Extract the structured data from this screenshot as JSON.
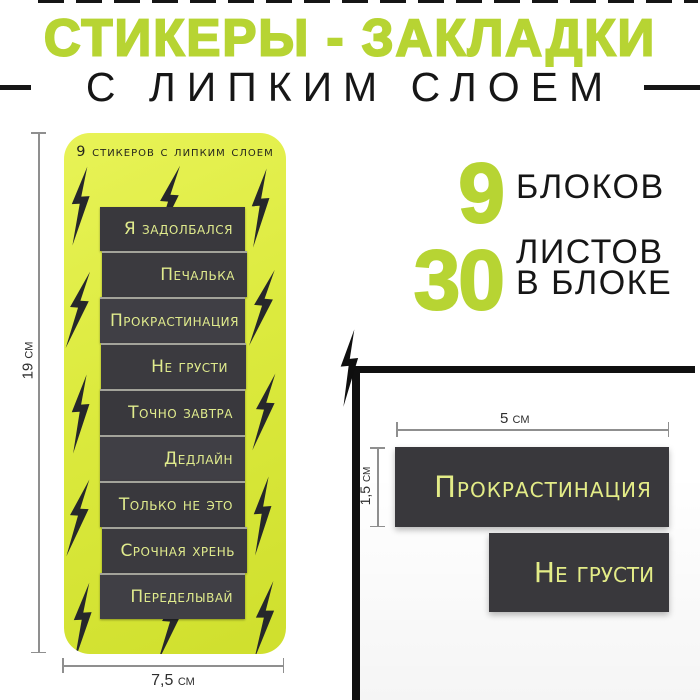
{
  "header": {
    "title": "СТИКЕРЫ - ЗАКЛАДКИ",
    "subtitle": "С ЛИПКИМ СЛОЕМ"
  },
  "card": {
    "header": "9 стикеров с липким слоем",
    "stickers": [
      "Я задолбался",
      "Печалька",
      "Прокрастинация",
      "Не грусти",
      "Точно завтра",
      "Дедлайн",
      "Только не это",
      "Срочная хрень",
      "Переделывай"
    ],
    "dim_height": "19 см",
    "dim_width": "7,5 см"
  },
  "features": [
    {
      "number": "9",
      "lines": [
        "БЛОКОВ"
      ]
    },
    {
      "number": "30",
      "lines": [
        "ЛИСТОВ",
        "В БЛОКЕ"
      ]
    }
  ],
  "photo": {
    "sticker_large": "Прокрастинация",
    "sticker_small": "Не грусти",
    "dim_width": "5 см",
    "dim_height": "1,5 см"
  },
  "colors": {
    "accent_green": "#b7d433",
    "card_green": "#dcea3e",
    "sticker_dark": "#3b3a3f",
    "sticker_text": "#e0eb8d",
    "ink_black": "#161616"
  }
}
